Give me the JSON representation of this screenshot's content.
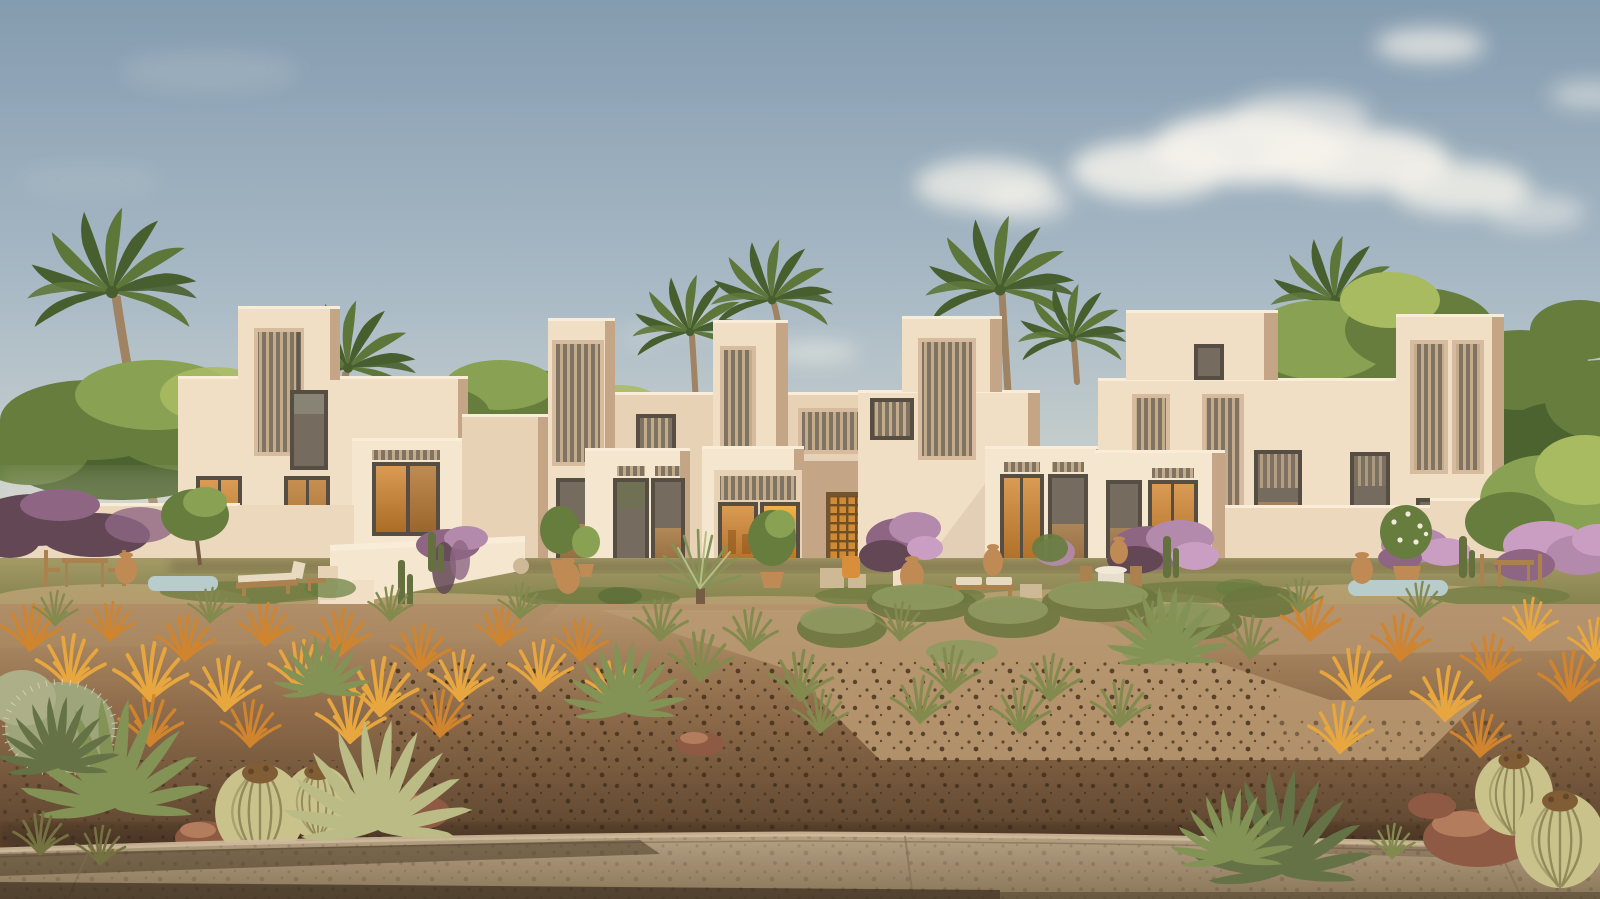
{
  "scene": {
    "type": "architectural-exterior-rendering",
    "setting": "modern adobe-style desert townhouse complex in warm late-afternoon light",
    "sky": "clear blue-grey sky with soft white cumulus clouds on the right",
    "buildings": "cluster of cream stucco cubic villas with stepped parapet towers, tall louvered slot windows, recessed porches and amber-lit doorways",
    "vegetation": [
      "date palms",
      "green deciduous trees",
      "bougainvillea on garden walls",
      "yucca",
      "potted olive trees",
      "orange ornamental grasses",
      "green grass tufts",
      "agaves",
      "barrel cacti",
      "fuzzy cholla cactus",
      "columnar cacti"
    ],
    "garden": [
      "perimeter walls",
      "staircase with parapet",
      "dining tables and chairs",
      "wooden loungers with white cushions",
      "terracotta urns",
      "two small plunge pools",
      "flagstone paths",
      "patchy lawn"
    ],
    "foreground": [
      "desert planting strip with dirt and dark mulch",
      "red rocks",
      "concrete sidewalk with curb and seams",
      "long shadows"
    ]
  },
  "palette": {
    "sky_top": "#7f9cb5",
    "sky_mid": "#a9bece",
    "sky_low": "#cdd8d5",
    "sky_horizon": "#e2e5da",
    "cloud": "#f6f7f3",
    "tree_dark": "#44602e",
    "tree_mid": "#5f7c3e",
    "tree_light": "#83a254",
    "tree_sun": "#a6bd62",
    "palm_dark": "#3f5c2e",
    "palm_mid": "#567539",
    "trunk": "#9b8264",
    "bldg_lit": "#f1e3cc",
    "bldg_lit2": "#f6ebd6",
    "bldg_mid": "#e7d5bc",
    "bldg_shade": "#d6bda3",
    "bldg_deep": "#c2a78b",
    "parapet_hi": "#faf2e2",
    "frame_dark": "#4e4a43",
    "glass_dark": "#6f6960",
    "glass_sky": "#aab4a6",
    "louver_bg": "#7b7164",
    "louver_slat": "#c0ad90",
    "amber_hi": "#f6b04d",
    "amber_mid": "#e0891f",
    "amber_deep": "#a55812",
    "wall": "#ecdcc3",
    "wall_shade": "#d9c3a8",
    "boug_dark": "#5c4356",
    "boug_mid": "#8a6487",
    "boug_light": "#b08ab0",
    "boug_pink": "#c99fc9",
    "lawn_hi": "#a09a68",
    "lawn_lo": "#787c48",
    "sand": "#c3aa7f",
    "stone": "#cdbb9b",
    "wood": "#a8814f",
    "cushion": "#e8ddc8",
    "urn": "#bd8a55",
    "pool": "#b6cfd2",
    "dirt_hi": "#b4946e",
    "dirt_mid": "#8a6a4b",
    "dirt_lo": "#503c2a",
    "mulch": "#3a2b1c",
    "grass_orange": "#cf832c",
    "grass_orange2": "#e8a83e",
    "tuft_green": "#7d8a4f",
    "tuft_olive": "#6f7042",
    "agave_green": "#7e9356",
    "agave_pale": "#b9bd8a",
    "agave_dark": "#5e7046",
    "cactus_body": "#c9c48f",
    "cactus_rib": "#8f8a5d",
    "cactus_top": "#7c5a34",
    "rock": "#8a5744",
    "rock_hi": "#b07c5e",
    "walk_hi": "#b2a186",
    "walk_lo": "#857459",
    "curb_hi": "#cdbda0",
    "shadow": "#2a1f13",
    "amber_chair": "#d98e3a"
  }
}
